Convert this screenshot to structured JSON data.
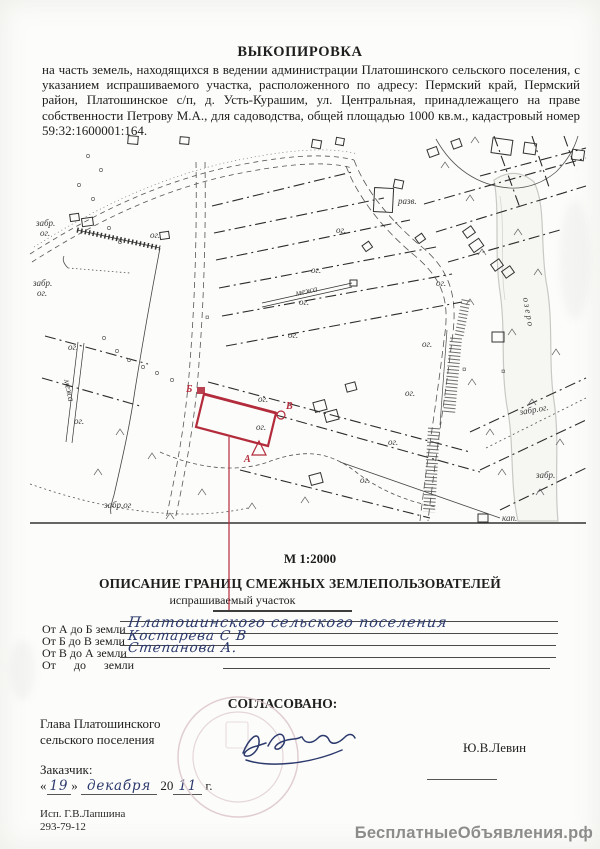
{
  "colors": {
    "accent_red": "#b32c3c",
    "ink": "#1e1e1e",
    "handwriting_ink": "#2c3a6d",
    "stamp_pink": "#dcc6ca",
    "watermark_gray": "#8c8c8a",
    "paper": "#fcfcfa"
  },
  "header": {
    "title": "ВЫКОПИРОВКА",
    "paragraph": "на часть земель, находящихся в ведении администрации Платошинского сельского поселения, с указанием испрашиваемого участка, расположенного по адресу: Пермский край, Пермский район, Платошинское с/п, д. Усть-Курашим, ул. Центральная, принадлежащего на праве собственности Петрову М.А., для садоводства, общей площадью 1000 кв.м., кадастровый номер 59:32:1600001:164."
  },
  "map": {
    "scale_label": "М 1:2000",
    "parcel": {
      "vertices": {
        "a": "А",
        "b": "Б",
        "v": "В"
      }
    },
    "labels": [
      {
        "t": "забр.",
        "x": 36,
        "y": 226
      },
      {
        "t": "ог.",
        "x": 40,
        "y": 236
      },
      {
        "t": "забр.",
        "x": 33,
        "y": 286
      },
      {
        "t": "ог.",
        "x": 37,
        "y": 296
      },
      {
        "t": "ог.",
        "x": 150,
        "y": 238
      },
      {
        "t": "разв.",
        "x": 398,
        "y": 204
      },
      {
        "t": "межа",
        "x": 296,
        "y": 296,
        "r": -12
      },
      {
        "t": "межа",
        "x": 64,
        "y": 380,
        "r": 78
      },
      {
        "t": "озеро",
        "x": 523,
        "y": 298,
        "r": 80,
        "f": "#8a8a86",
        "s": 2
      },
      {
        "t": "ог.",
        "x": 336,
        "y": 233
      },
      {
        "t": "ог.",
        "x": 311,
        "y": 273
      },
      {
        "t": "ог.",
        "x": 299,
        "y": 305
      },
      {
        "t": "ог.",
        "x": 288,
        "y": 338
      },
      {
        "t": "ог.",
        "x": 436,
        "y": 286
      },
      {
        "t": "ог.",
        "x": 422,
        "y": 347
      },
      {
        "t": "ог.",
        "x": 405,
        "y": 396
      },
      {
        "t": "ог.",
        "x": 388,
        "y": 445
      },
      {
        "t": "ог.",
        "x": 360,
        "y": 483
      },
      {
        "t": "ог.",
        "x": 258,
        "y": 402
      },
      {
        "t": "ог.",
        "x": 256,
        "y": 430
      },
      {
        "t": "ог.",
        "x": 68,
        "y": 350
      },
      {
        "t": "ог.",
        "x": 74,
        "y": 424
      },
      {
        "t": "забр.ог",
        "x": 104,
        "y": 508
      },
      {
        "t": "забр.ог.",
        "x": 520,
        "y": 415,
        "r": -10
      },
      {
        "t": "забр.",
        "x": 536,
        "y": 478
      },
      {
        "t": "кап.",
        "x": 502,
        "y": 521
      }
    ]
  },
  "description": {
    "section_title": "ОПИСАНИЕ ГРАНИЦ СМЕЖНЫХ ЗЕМЛЕПОЛЬЗОВАТЕЛЕЙ",
    "callout": "испрашиваемый участок",
    "rows": [
      {
        "label": "От А до Б земли",
        "value": "Платошинского сельского поселения"
      },
      {
        "label": "От Б до В земли",
        "value": "Костарева С В"
      },
      {
        "label": "От В до А земли",
        "value": "Степанова А."
      },
      {
        "label": "От      до      земли",
        "value": ""
      }
    ]
  },
  "approval": {
    "heading": "СОГЛАСОВАНО:",
    "role_line1": "Глава Платошинского",
    "role_line2": "сельского поселения",
    "name": "Ю.В.Левин"
  },
  "customer": {
    "label": "Заказчик:",
    "quote_open": "«",
    "day": "19",
    "quote_close": "»",
    "month": "декабря",
    "year_prefix": "20",
    "year": "11",
    "year_suffix": "г."
  },
  "executor": {
    "line1": "Исп. Г.В.Лапшина",
    "line2": "293-79-12"
  },
  "watermark": {
    "text": "БесплатныеОбъявления.рф"
  }
}
